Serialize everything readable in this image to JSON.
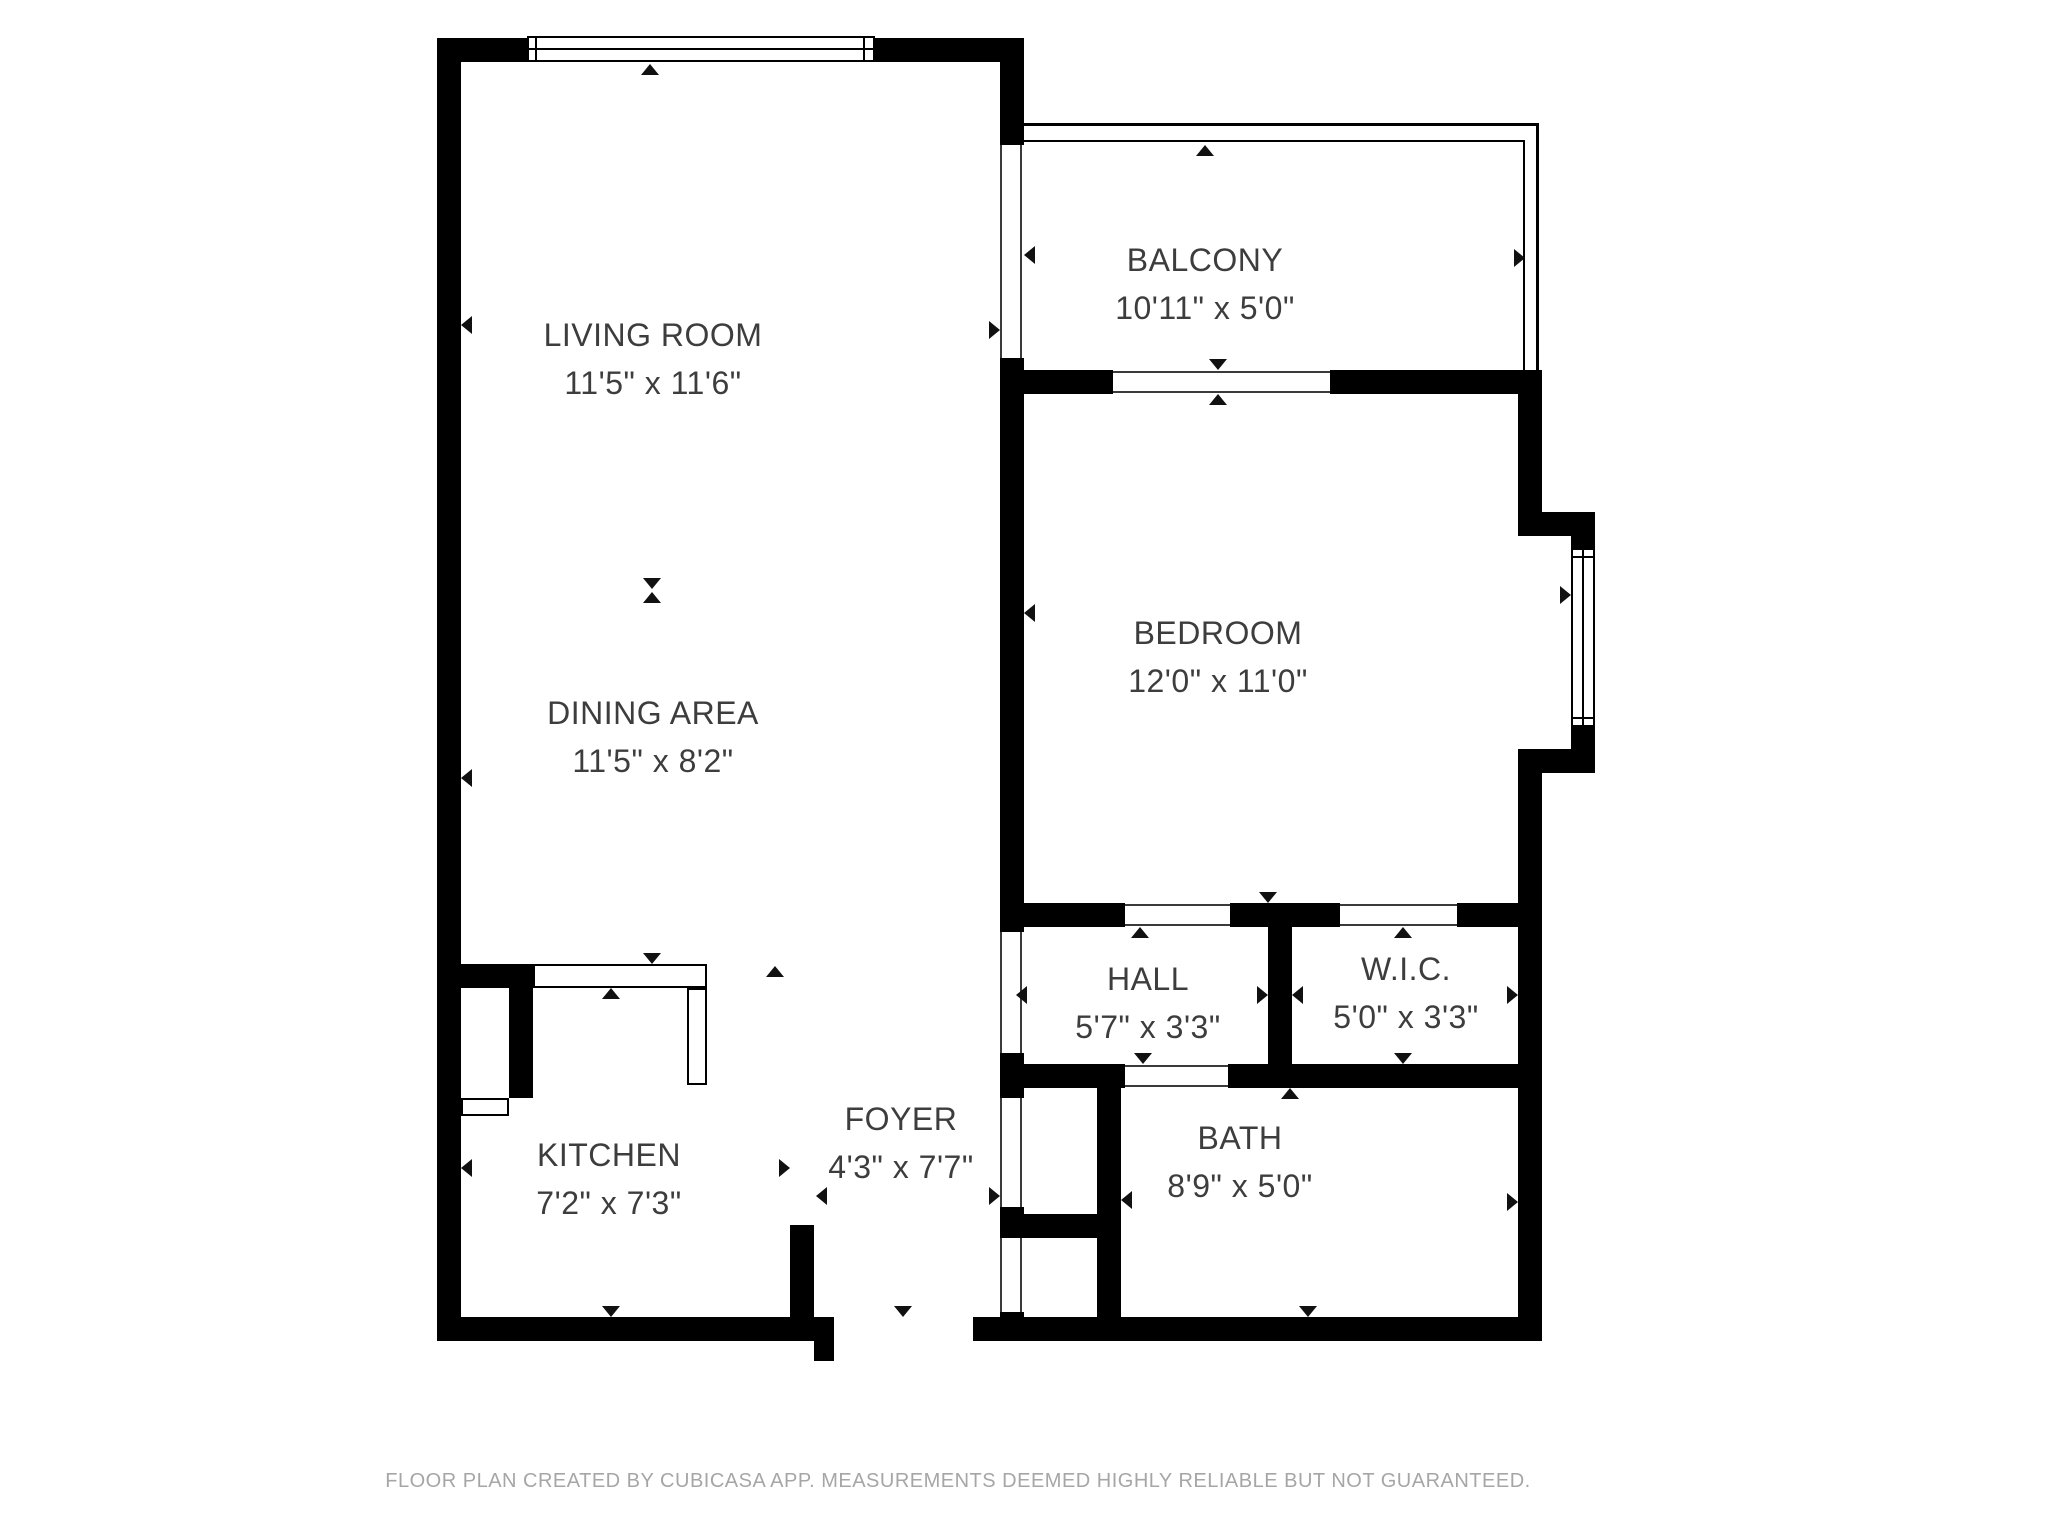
{
  "floor_plan": {
    "rooms": [
      {
        "id": "living-room",
        "name": "LIVING ROOM",
        "dimensions": "11'5\" x 11'6\""
      },
      {
        "id": "dining-area",
        "name": "DINING AREA",
        "dimensions": "11'5\" x 8'2\""
      },
      {
        "id": "balcony",
        "name": "BALCONY",
        "dimensions": "10'11\" x 5'0\""
      },
      {
        "id": "bedroom",
        "name": "BEDROOM",
        "dimensions": "12'0\" x 11'0\""
      },
      {
        "id": "hall",
        "name": "HALL",
        "dimensions": "5'7\" x 3'3\""
      },
      {
        "id": "wic",
        "name": "W.I.C.",
        "dimensions": "5'0\" x 3'3\""
      },
      {
        "id": "bath",
        "name": "BATH",
        "dimensions": "8'9\" x 5'0\""
      },
      {
        "id": "kitchen",
        "name": "KITCHEN",
        "dimensions": "7'2\" x 7'3\""
      },
      {
        "id": "foyer",
        "name": "FOYER",
        "dimensions": "4'3\" x 7'7\""
      }
    ],
    "footer_disclaimer": "FLOOR PLAN CREATED BY CUBICASA APP. MEASUREMENTS DEEMED HIGHLY RELIABLE BUT NOT GUARANTEED.",
    "colors": {
      "wall": "#000000",
      "background": "#ffffff",
      "label_text": "#3d3d3d",
      "footer_text": "#a6a6a6"
    },
    "icons": {
      "measure_arrow": "small solid triangle (up/down/left/right)",
      "window": "double-line rectangle",
      "balcony_railing": "double thin line",
      "door_opening": "white gap in wall with thin edge lines"
    }
  }
}
